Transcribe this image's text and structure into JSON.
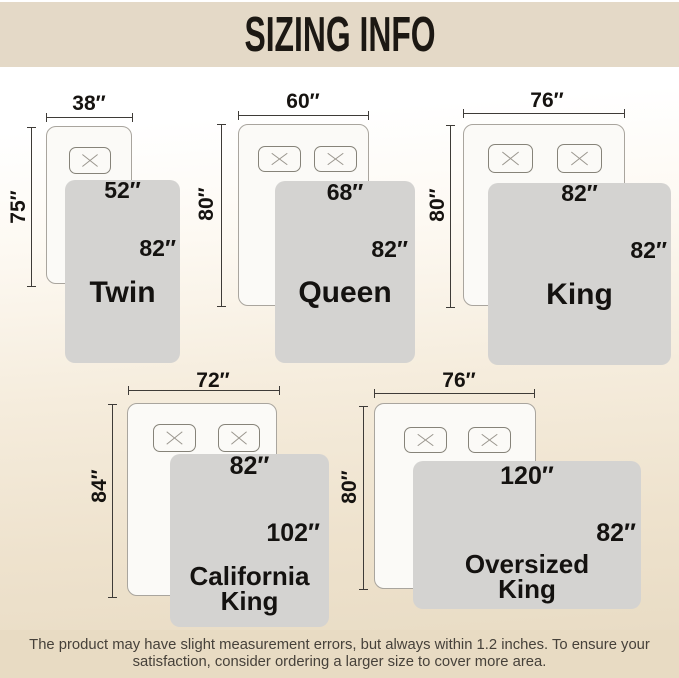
{
  "header": {
    "title": "SIZING INFO"
  },
  "diagrams": [
    {
      "name": "Twin",
      "mattress_width": "38″",
      "mattress_length": "75″",
      "blanket_width": "52″",
      "blanket_length": "82″"
    },
    {
      "name": "Queen",
      "mattress_width": "60″",
      "mattress_length": "80″",
      "blanket_width": "68″",
      "blanket_length": "82″"
    },
    {
      "name": "King",
      "mattress_width": "76″",
      "mattress_length": "80″",
      "blanket_width": "82″",
      "blanket_length": "82″"
    },
    {
      "name": "California King",
      "mattress_width": "72″",
      "mattress_length": "84″",
      "blanket_width": "82″",
      "blanket_length": "102″"
    },
    {
      "name": "Oversized King",
      "mattress_width": "76″",
      "mattress_length": "80″",
      "blanket_width": "120″",
      "blanket_length": "82″"
    }
  ],
  "footer": {
    "line1": "The product may have slight measurement errors, but always within 1.2 inches. To ensure your",
    "line2": "satisfaction, consider ordering a larger size to cover more area."
  },
  "colors": {
    "header_bg": "#e4d9c7",
    "footer_bg": "#e8dbc3",
    "blanket_fill": "#d4d3d1",
    "bed_fill": "#fbfaf7",
    "bed_border": "#a9a59e",
    "dimension_line": "#3e3b37",
    "label_text": "#161310"
  }
}
